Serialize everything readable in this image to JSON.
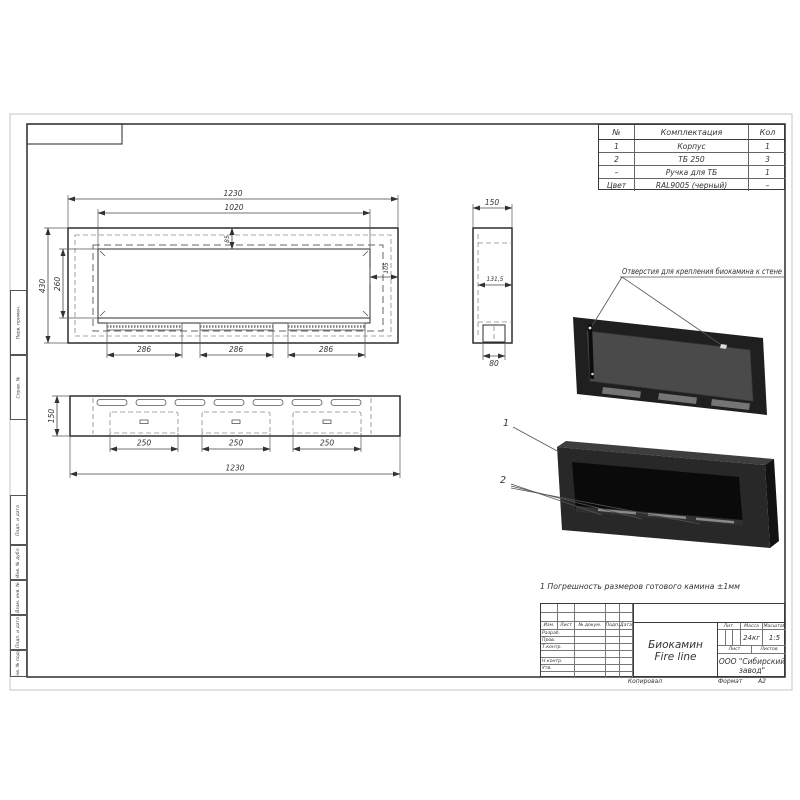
{
  "sheet": {
    "copied_label": "Копировал",
    "format_label": "Формат",
    "format_value": "А2"
  },
  "parts_table": {
    "headers": {
      "num": "№",
      "name": "Комплектация",
      "qty": "Кол"
    },
    "rows": [
      {
        "num": "1",
        "name": "Корпус",
        "qty": "1"
      },
      {
        "num": "2",
        "name": "ТБ 250",
        "qty": "3"
      },
      {
        "num": "–",
        "name": "Ручка для ТБ",
        "qty": "1"
      },
      {
        "num": "Цвет",
        "name": "RAL9005 (черный)",
        "qty": "–"
      }
    ]
  },
  "views": {
    "front": {
      "dim_width_outer": "1230",
      "dim_width_inner": "1020",
      "dim_height_outer": "430",
      "dim_height_inner": "260",
      "dim_top_offset": "85",
      "dim_side_offset": "105",
      "dim_slot_1": "286",
      "dim_slot_2": "286",
      "dim_slot_3": "286"
    },
    "side": {
      "dim_depth": "150",
      "dim_inner_depth": "131,5",
      "dim_burner": "80"
    },
    "bottom": {
      "dim_depth": "150",
      "dim_slot_1": "250",
      "dim_slot_2": "250",
      "dim_slot_3": "250",
      "dim_width": "1230"
    }
  },
  "annotations": {
    "mount_holes": "Отверстия для крепления биокамина к стене",
    "callout_1": "1",
    "callout_2": "2",
    "note": "1 Погрешность размеров готового камина ±1мм"
  },
  "title_block": {
    "title_line1": "Биокамин",
    "title_line2": "Fire line",
    "col_izm": "Изм.",
    "col_list": "Лист",
    "col_doc": "№ докум.",
    "col_podp": "Подп.",
    "col_data": "Дата",
    "row_razrab": "Разраб.",
    "row_prov": "Пров.",
    "row_tkontr": "Т.контр.",
    "row_nkontr": "Н.контр.",
    "row_utv": "Утв.",
    "lit_label": "Лит.",
    "mass_label": "Масса",
    "scale_label": "Масштаб",
    "mass_value": "24кг",
    "scale_value": "1:5",
    "sheet_label": "Лист",
    "sheets_label": "Листов",
    "company_line1": "ООО \"Сибирский",
    "company_line2": "завод\""
  },
  "margin_stamps": [
    "Перв. примен.",
    "Справ. №",
    "Подп. и дата",
    "Инв. № дубл.",
    "Взам. инв. №",
    "Подп. и дата",
    "Инв. № подл."
  ]
}
